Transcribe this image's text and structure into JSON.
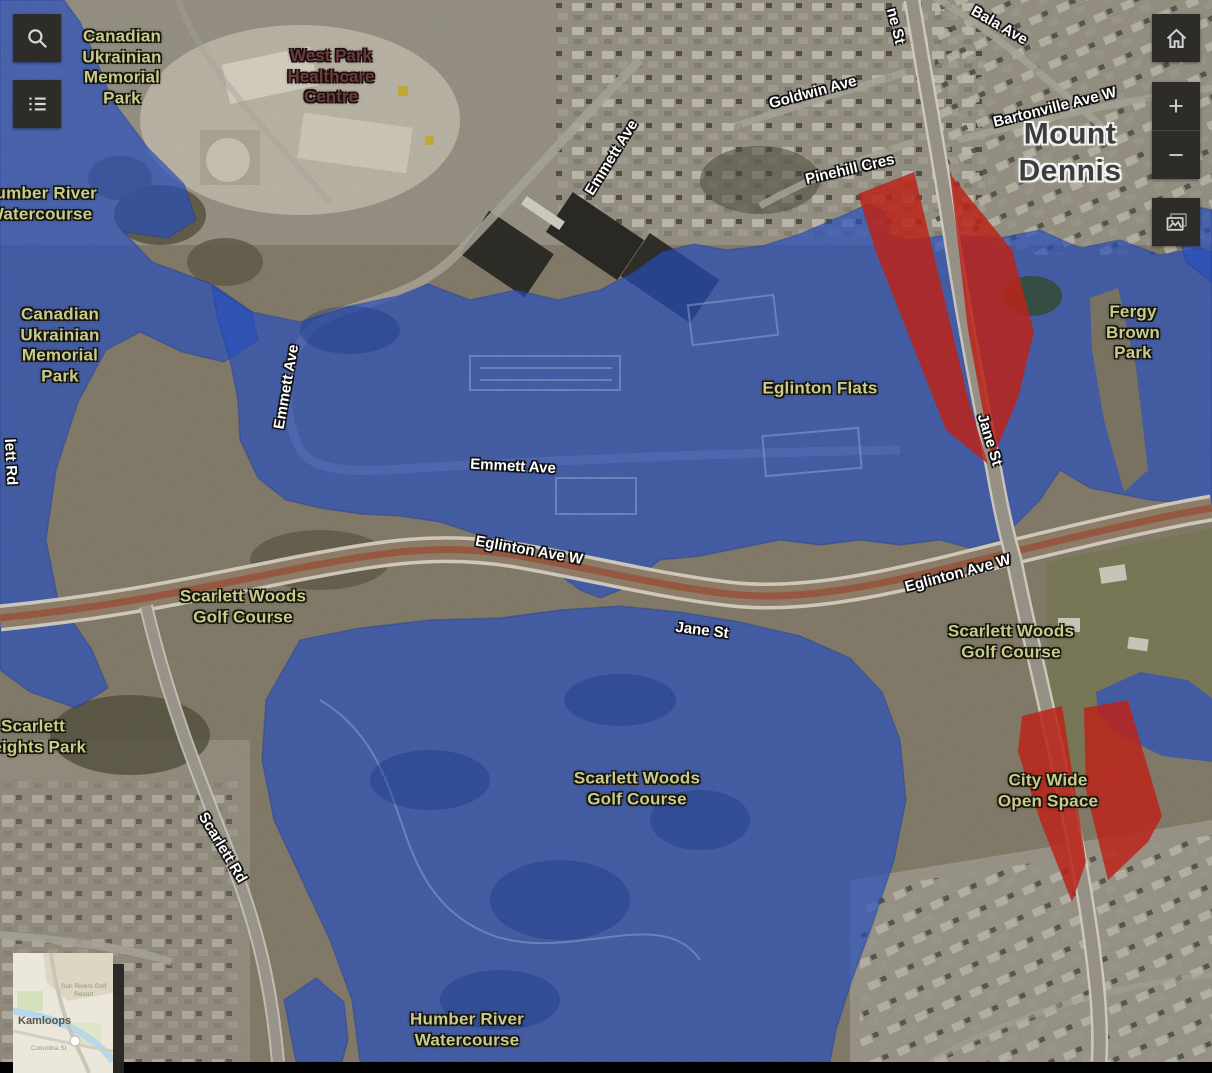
{
  "app": {
    "name": "Flood map viewer"
  },
  "controls": {
    "search": {
      "icon": "search-icon"
    },
    "layer_list": {
      "icon": "list-icon"
    },
    "home": {
      "icon": "home-icon"
    },
    "zoom_in": {
      "icon": "plus-icon",
      "glyph": "+"
    },
    "zoom_out": {
      "icon": "minus-icon",
      "glyph": "−"
    },
    "basemap": {
      "icon": "image-icon"
    }
  },
  "legend": {
    "flood_overlay_color": "#2b57d2",
    "highlight_color": "#d0281c",
    "park_label_color": "#c9cc8b",
    "road_label_color": "#ffffff"
  },
  "map_labels": [
    {
      "kind": "park",
      "text": "Canadian\nUkrainian\nMemorial\nPark"
    },
    {
      "kind": "facility",
      "text": "West Park\nHealthcare\nCentre"
    },
    {
      "kind": "park",
      "text": "Humber River\nWatercourse"
    },
    {
      "kind": "park",
      "text": "Canadian\nUkrainian\nMemorial\nPark"
    },
    {
      "kind": "road",
      "text": "lett Rd"
    },
    {
      "kind": "road",
      "text": "Emmett Ave"
    },
    {
      "kind": "road",
      "text": "Emmett Ave"
    },
    {
      "kind": "road",
      "text": "Emmett Ave"
    },
    {
      "kind": "road",
      "text": "Goldwin Ave"
    },
    {
      "kind": "road",
      "text": "Bala Ave"
    },
    {
      "kind": "road",
      "text": "ne St"
    },
    {
      "kind": "road",
      "text": "Pinehill Cres"
    },
    {
      "kind": "road",
      "text": "Bartonville Ave W"
    },
    {
      "kind": "place",
      "text": "Mount Dennis"
    },
    {
      "kind": "park",
      "text": "Fergy Brown\nPark"
    },
    {
      "kind": "park",
      "text": "Eglinton Flats"
    },
    {
      "kind": "road",
      "text": "Jane St"
    },
    {
      "kind": "road",
      "text": "Eglinton Ave W"
    },
    {
      "kind": "road",
      "text": "Eglinton Ave W"
    },
    {
      "kind": "park",
      "text": "Scarlett Woods\nGolf Course"
    },
    {
      "kind": "road",
      "text": "Jane St"
    },
    {
      "kind": "park",
      "text": "Scarlett Woods\nGolf Course"
    },
    {
      "kind": "park",
      "text": "Scarlett\nHeights Park"
    },
    {
      "kind": "park",
      "text": "Scarlett Woods\nGolf Course"
    },
    {
      "kind": "park",
      "text": "City Wide\nOpen Space"
    },
    {
      "kind": "road",
      "text": "Scarlett Rd"
    },
    {
      "kind": "park",
      "text": "Humber River\nWatercourse"
    }
  ],
  "overview_map": {
    "place": "Kamloops",
    "poi": "Sun Rivers Golf\nResort",
    "street": "Columbia St"
  }
}
